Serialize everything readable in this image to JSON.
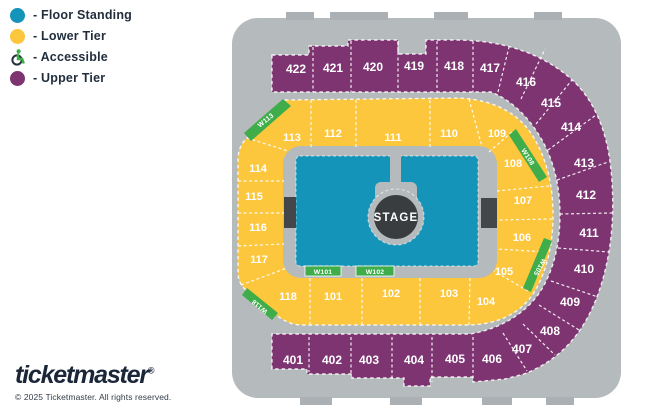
{
  "legend": {
    "floor_standing": "- Floor Standing",
    "lower_tier": "- Lower Tier",
    "accessible": "- Accessible",
    "upper_tier": "- Upper Tier"
  },
  "map": {
    "stage": "STAGE",
    "lower": {
      "s101": "101",
      "s102": "102",
      "s103": "103",
      "s104": "104",
      "s105": "105",
      "s106": "106",
      "s107": "107",
      "s108": "108",
      "s109": "109",
      "s110": "110",
      "s111": "111",
      "s112": "112",
      "s113": "113",
      "s114": "114",
      "s115": "115",
      "s116": "116",
      "s117": "117",
      "s118": "118"
    },
    "upper": {
      "s401": "401",
      "s402": "402",
      "s403": "403",
      "s404": "404",
      "s405": "405",
      "s406": "406",
      "s407": "407",
      "s408": "408",
      "s409": "409",
      "s410": "410",
      "s411": "411",
      "s412": "412",
      "s413": "413",
      "s414": "414",
      "s415": "415",
      "s416": "416",
      "s417": "417",
      "s418": "418",
      "s419": "419",
      "s420": "420",
      "s421": "421",
      "s422": "422"
    },
    "walkways": {
      "w101": "W101",
      "w102": "W102",
      "w105": "W105",
      "w108": "W108",
      "w113": "W113",
      "w118": "W118"
    }
  },
  "footer": {
    "brand": "ticketmaster",
    "registered": "®",
    "copyright": "© 2025 Ticketmaster. All rights reserved."
  },
  "colors": {
    "floor_standing": "#1494b8",
    "lower_tier": "#fcc63d",
    "upper_tier": "#7d3471",
    "walkway_green": "#3fad4a",
    "arena_gray": "#b5babd",
    "stage_dark": "#3a3d40",
    "text_dark": "#1f2b3d"
  }
}
